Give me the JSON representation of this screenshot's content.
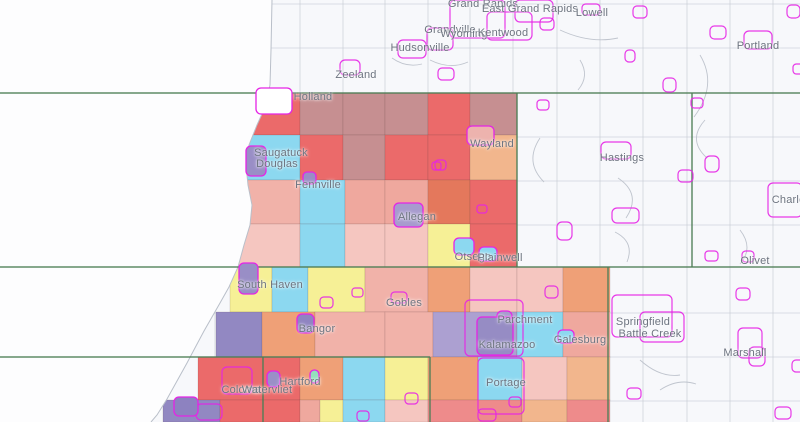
{
  "map": {
    "style": {
      "land_bg": "#f7f8fb",
      "lake_color": "#fdfdfe",
      "coast_color": "#b9bfc9",
      "grid_line_color": "#c6cbd4",
      "road_color": "#b9bfc9",
      "county_line_color": "#4f7f57",
      "city_outline_color": "#e524e5",
      "cell_stroke": "rgba(90,60,60,0.18)",
      "label_color": "#6d7480"
    },
    "legend_note": "choropleth of township/tract cells",
    "cells": [
      {
        "x": 240,
        "y": 93,
        "w": 60,
        "h": 42,
        "c": "#eb6a6a"
      },
      {
        "x": 300,
        "y": 93,
        "w": 43,
        "h": 42,
        "c": "#c68f91"
      },
      {
        "x": 343,
        "y": 93,
        "w": 42,
        "h": 42,
        "c": "#c68f91"
      },
      {
        "x": 385,
        "y": 93,
        "w": 43,
        "h": 42,
        "c": "#c68f91"
      },
      {
        "x": 428,
        "y": 93,
        "w": 42,
        "h": 42,
        "c": "#eb6a6a"
      },
      {
        "x": 470,
        "y": 93,
        "w": 47,
        "h": 42,
        "c": "#c68f91"
      },
      {
        "x": 225,
        "y": 135,
        "w": 75,
        "h": 45,
        "c": "#8cd8f0"
      },
      {
        "x": 300,
        "y": 135,
        "w": 43,
        "h": 45,
        "c": "#eb6a6a"
      },
      {
        "x": 343,
        "y": 135,
        "w": 42,
        "h": 45,
        "c": "#c68f91"
      },
      {
        "x": 385,
        "y": 135,
        "w": 43,
        "h": 45,
        "c": "#eb6a6a"
      },
      {
        "x": 428,
        "y": 135,
        "w": 42,
        "h": 45,
        "c": "#eb6a6a"
      },
      {
        "x": 470,
        "y": 135,
        "w": 47,
        "h": 45,
        "c": "#f2b68d"
      },
      {
        "x": 228,
        "y": 180,
        "w": 72,
        "h": 44,
        "c": "#f1b2a9"
      },
      {
        "x": 300,
        "y": 180,
        "w": 45,
        "h": 44,
        "c": "#8cd8f0"
      },
      {
        "x": 345,
        "y": 180,
        "w": 40,
        "h": 44,
        "c": "#efa89e"
      },
      {
        "x": 385,
        "y": 180,
        "w": 43,
        "h": 44,
        "c": "#efa89e"
      },
      {
        "x": 428,
        "y": 180,
        "w": 42,
        "h": 44,
        "c": "#e4785c"
      },
      {
        "x": 470,
        "y": 180,
        "w": 47,
        "h": 44,
        "c": "#eb6a6a"
      },
      {
        "x": 234,
        "y": 224,
        "w": 66,
        "h": 43,
        "c": "#f5c6c0"
      },
      {
        "x": 300,
        "y": 224,
        "w": 45,
        "h": 43,
        "c": "#8cd8f0"
      },
      {
        "x": 345,
        "y": 224,
        "w": 40,
        "h": 43,
        "c": "#f5c6c0"
      },
      {
        "x": 385,
        "y": 224,
        "w": 43,
        "h": 43,
        "c": "#f5c6c0"
      },
      {
        "x": 428,
        "y": 224,
        "w": 42,
        "h": 43,
        "c": "#f6f096"
      },
      {
        "x": 470,
        "y": 224,
        "w": 47,
        "h": 43,
        "c": "#eb6a6a"
      },
      {
        "x": 230,
        "y": 267,
        "w": 42,
        "h": 45,
        "c": "#f6f096"
      },
      {
        "x": 272,
        "y": 267,
        "w": 36,
        "h": 45,
        "c": "#8cd8f0"
      },
      {
        "x": 308,
        "y": 267,
        "w": 57,
        "h": 45,
        "c": "#f6f096"
      },
      {
        "x": 365,
        "y": 267,
        "w": 63,
        "h": 45,
        "c": "#f1b2a9"
      },
      {
        "x": 428,
        "y": 267,
        "w": 42,
        "h": 45,
        "c": "#efa077"
      },
      {
        "x": 470,
        "y": 267,
        "w": 47,
        "h": 45,
        "c": "#f5c6c0"
      },
      {
        "x": 517,
        "y": 267,
        "w": 46,
        "h": 45,
        "c": "#f5c6c0"
      },
      {
        "x": 563,
        "y": 267,
        "w": 47,
        "h": 45,
        "c": "#efa077"
      },
      {
        "x": 216,
        "y": 312,
        "w": 46,
        "h": 45,
        "c": "#9288c2"
      },
      {
        "x": 262,
        "y": 312,
        "w": 53,
        "h": 45,
        "c": "#efa077"
      },
      {
        "x": 315,
        "y": 312,
        "w": 70,
        "h": 45,
        "c": "#f1b2a9"
      },
      {
        "x": 385,
        "y": 312,
        "w": 48,
        "h": 45,
        "c": "#f1b2a9"
      },
      {
        "x": 433,
        "y": 312,
        "w": 84,
        "h": 45,
        "c": "#aca0d1"
      },
      {
        "x": 517,
        "y": 312,
        "w": 46,
        "h": 45,
        "c": "#8cd8f0"
      },
      {
        "x": 563,
        "y": 312,
        "w": 47,
        "h": 45,
        "c": "#efa89e"
      },
      {
        "x": 198,
        "y": 357,
        "w": 65,
        "h": 43,
        "c": "#eb6a6a"
      },
      {
        "x": 263,
        "y": 357,
        "w": 37,
        "h": 43,
        "c": "#eb6a6a"
      },
      {
        "x": 300,
        "y": 357,
        "w": 43,
        "h": 43,
        "c": "#efa077"
      },
      {
        "x": 343,
        "y": 357,
        "w": 42,
        "h": 43,
        "c": "#8cd8f0"
      },
      {
        "x": 385,
        "y": 357,
        "w": 43,
        "h": 43,
        "c": "#f6f096"
      },
      {
        "x": 428,
        "y": 357,
        "w": 50,
        "h": 43,
        "c": "#efa077"
      },
      {
        "x": 478,
        "y": 357,
        "w": 44,
        "h": 43,
        "c": "#8cd8f0"
      },
      {
        "x": 522,
        "y": 357,
        "w": 45,
        "h": 43,
        "c": "#f5c6c0"
      },
      {
        "x": 567,
        "y": 357,
        "w": 43,
        "h": 43,
        "c": "#f2b68d"
      },
      {
        "x": 163,
        "y": 400,
        "w": 57,
        "h": 22,
        "c": "#9288c2"
      },
      {
        "x": 220,
        "y": 400,
        "w": 43,
        "h": 22,
        "c": "#eb6a6a"
      },
      {
        "x": 263,
        "y": 400,
        "w": 37,
        "h": 22,
        "c": "#eb6a6a"
      },
      {
        "x": 300,
        "y": 400,
        "w": 20,
        "h": 22,
        "c": "#efa89e"
      },
      {
        "x": 320,
        "y": 400,
        "w": 23,
        "h": 22,
        "c": "#f6f096"
      },
      {
        "x": 343,
        "y": 400,
        "w": 42,
        "h": 22,
        "c": "#8cd8f0"
      },
      {
        "x": 385,
        "y": 400,
        "w": 43,
        "h": 22,
        "c": "#f5c6c0"
      },
      {
        "x": 428,
        "y": 400,
        "w": 94,
        "h": 22,
        "c": "#ee8b8b"
      },
      {
        "x": 522,
        "y": 400,
        "w": 45,
        "h": 22,
        "c": "#f2b68d"
      },
      {
        "x": 567,
        "y": 400,
        "w": 43,
        "h": 22,
        "c": "#ee8b8b"
      }
    ],
    "lake": {
      "points": "272,0 271,50 270,85 266,105 257,125 249,145 246,165 248,185 252,205 250,225 244,245 238,267 229,287 220,303 212,317 204,331 196,346 187,363 177,381 167,399 157,415 151,422 0,422 0,0",
      "coast": "272,0 271,50 270,85 266,105 257,125 249,145 246,165 248,185 252,205 250,225 244,245 238,267 229,287 220,303 212,317 204,331 196,346 187,363 177,381 167,399 157,415 151,422"
    },
    "grid": {
      "v": [
        215,
        258,
        300,
        343,
        385,
        428,
        470,
        513,
        557,
        600,
        643,
        687,
        730,
        773
      ],
      "v_y1": 0,
      "v_y2": 422,
      "h": [
        4,
        48,
        137,
        181,
        225,
        313,
        357,
        401
      ],
      "h_x1": 205,
      "h_x2": 800
    },
    "county_lines": [
      {
        "x1": 0,
        "y1": 93,
        "x2": 800,
        "y2": 93
      },
      {
        "x1": 0,
        "y1": 267,
        "x2": 800,
        "y2": 267
      },
      {
        "x1": 0,
        "y1": 357,
        "x2": 430,
        "y2": 357
      },
      {
        "x1": 517,
        "y1": 93,
        "x2": 517,
        "y2": 267
      },
      {
        "x1": 692,
        "y1": 93,
        "x2": 692,
        "y2": 267
      },
      {
        "x1": 608,
        "y1": 267,
        "x2": 608,
        "y2": 422
      },
      {
        "x1": 263,
        "y1": 357,
        "x2": 263,
        "y2": 422
      },
      {
        "x1": 430,
        "y1": 357,
        "x2": 430,
        "y2": 422
      }
    ],
    "roads": [
      "M430,60 q20,10 38,2",
      "M560,30 q30,14 58,8",
      "M700,55 q18,30 -6,62",
      "M618,178 q24,16 8,40",
      "M640,360 q20,18 40,15",
      "M540,138 q-16,24 4,44",
      "M392,58 q14,10 30,6",
      "M705,120 q-18,20 2,38",
      "M615,232 q20,10 12,30",
      "M660,390 q18,-12 36,-6",
      "M740,230 q14,18 0,34",
      "M580,60 q10,16 -2,30"
    ],
    "outlines": [
      {
        "x": 450,
        "y": 0,
        "w": 55,
        "h": 38
      },
      {
        "x": 487,
        "y": 12,
        "w": 45,
        "h": 28
      },
      {
        "x": 515,
        "y": 0,
        "w": 38,
        "h": 22
      },
      {
        "x": 427,
        "y": 28,
        "w": 26,
        "h": 22
      },
      {
        "x": 398,
        "y": 40,
        "w": 28,
        "h": 18
      },
      {
        "x": 340,
        "y": 60,
        "w": 20,
        "h": 15
      },
      {
        "x": 582,
        "y": 4,
        "w": 18,
        "h": 11
      },
      {
        "x": 540,
        "y": 18,
        "w": 14,
        "h": 12
      },
      {
        "x": 633,
        "y": 6,
        "w": 14,
        "h": 12
      },
      {
        "x": 710,
        "y": 26,
        "w": 16,
        "h": 13
      },
      {
        "x": 744,
        "y": 31,
        "w": 28,
        "h": 18
      },
      {
        "x": 787,
        "y": 5,
        "w": 13,
        "h": 13
      },
      {
        "x": 625,
        "y": 50,
        "w": 10,
        "h": 12
      },
      {
        "x": 663,
        "y": 78,
        "w": 13,
        "h": 14
      },
      {
        "x": 793,
        "y": 64,
        "w": 10,
        "h": 10
      },
      {
        "x": 438,
        "y": 68,
        "w": 16,
        "h": 12
      },
      {
        "x": 601,
        "y": 142,
        "w": 30,
        "h": 17
      },
      {
        "x": 705,
        "y": 156,
        "w": 14,
        "h": 16
      },
      {
        "x": 678,
        "y": 170,
        "w": 15,
        "h": 12
      },
      {
        "x": 612,
        "y": 208,
        "w": 27,
        "h": 15
      },
      {
        "x": 557,
        "y": 222,
        "w": 15,
        "h": 18
      },
      {
        "x": 768,
        "y": 183,
        "w": 34,
        "h": 34
      },
      {
        "x": 742,
        "y": 251,
        "w": 12,
        "h": 11
      },
      {
        "x": 705,
        "y": 251,
        "w": 13,
        "h": 10
      },
      {
        "x": 736,
        "y": 288,
        "w": 14,
        "h": 12
      },
      {
        "x": 612,
        "y": 295,
        "w": 60,
        "h": 42
      },
      {
        "x": 640,
        "y": 312,
        "w": 44,
        "h": 30
      },
      {
        "x": 738,
        "y": 328,
        "w": 24,
        "h": 30
      },
      {
        "x": 749,
        "y": 347,
        "w": 16,
        "h": 19
      },
      {
        "x": 792,
        "y": 360,
        "w": 12,
        "h": 12
      },
      {
        "x": 775,
        "y": 407,
        "w": 16,
        "h": 12
      },
      {
        "x": 435,
        "y": 160,
        "w": 11,
        "h": 10
      },
      {
        "x": 320,
        "y": 297,
        "w": 13,
        "h": 11
      },
      {
        "x": 352,
        "y": 288,
        "w": 11,
        "h": 9
      },
      {
        "x": 391,
        "y": 292,
        "w": 16,
        "h": 11
      },
      {
        "x": 405,
        "y": 393,
        "w": 13,
        "h": 11
      },
      {
        "x": 357,
        "y": 411,
        "w": 12,
        "h": 10
      },
      {
        "x": 478,
        "y": 409,
        "w": 18,
        "h": 12
      },
      {
        "x": 509,
        "y": 397,
        "w": 12,
        "h": 10
      },
      {
        "x": 545,
        "y": 286,
        "w": 13,
        "h": 12
      },
      {
        "x": 477,
        "y": 205,
        "w": 10,
        "h": 8
      },
      {
        "x": 432,
        "y": 162,
        "w": 9,
        "h": 8
      },
      {
        "x": 222,
        "y": 367,
        "w": 30,
        "h": 27
      },
      {
        "x": 478,
        "y": 358,
        "w": 46,
        "h": 56
      },
      {
        "x": 465,
        "y": 300,
        "w": 58,
        "h": 56
      },
      {
        "x": 196,
        "y": 404,
        "w": 26,
        "h": 16
      },
      {
        "x": 627,
        "y": 388,
        "w": 14,
        "h": 11
      },
      {
        "x": 691,
        "y": 98,
        "w": 12,
        "h": 10
      },
      {
        "x": 537,
        "y": 100,
        "w": 12,
        "h": 10
      }
    ],
    "markers": [
      {
        "x": 256,
        "y": 88,
        "w": 36,
        "h": 26,
        "fill": "#ffffff"
      },
      {
        "x": 246,
        "y": 146,
        "w": 20,
        "h": 30,
        "fill": "#998ec6"
      },
      {
        "x": 303,
        "y": 172,
        "w": 13,
        "h": 12,
        "fill": "#998ec6"
      },
      {
        "x": 394,
        "y": 203,
        "w": 29,
        "h": 24,
        "fill": "#a79bce"
      },
      {
        "x": 467,
        "y": 126,
        "w": 27,
        "h": 19,
        "fill": "#edb3ae"
      },
      {
        "x": 454,
        "y": 238,
        "w": 20,
        "h": 17,
        "fill": "#8cd8f0"
      },
      {
        "x": 479,
        "y": 247,
        "w": 18,
        "h": 14,
        "fill": "#8cd8f0"
      },
      {
        "x": 239,
        "y": 263,
        "w": 19,
        "h": 31,
        "fill": "#998ec6"
      },
      {
        "x": 297,
        "y": 314,
        "w": 17,
        "h": 19,
        "fill": "#8f84c1"
      },
      {
        "x": 497,
        "y": 311,
        "w": 15,
        "h": 15,
        "fill": "#a79bce"
      },
      {
        "x": 477,
        "y": 317,
        "w": 36,
        "h": 38,
        "fill": "#968cc4"
      },
      {
        "x": 310,
        "y": 370,
        "w": 9,
        "h": 13,
        "fill": "#93e0bd"
      },
      {
        "x": 267,
        "y": 371,
        "w": 13,
        "h": 16,
        "fill": "#9a8fc7"
      },
      {
        "x": 558,
        "y": 330,
        "w": 16,
        "h": 13,
        "fill": "#8cd8f0"
      },
      {
        "x": 174,
        "y": 397,
        "w": 24,
        "h": 19,
        "fill": "#8d82c0"
      }
    ],
    "labels": [
      {
        "text": "Grand Rapids",
        "x": 483,
        "y": 4
      },
      {
        "text": "East Grand Rapids",
        "x": 530,
        "y": 9
      },
      {
        "text": "Grandville",
        "x": 450,
        "y": 30
      },
      {
        "text": "Wyoming",
        "x": 464,
        "y": 34
      },
      {
        "text": "Kentwood",
        "x": 503,
        "y": 33
      },
      {
        "text": "Hudsonville",
        "x": 420,
        "y": 48
      },
      {
        "text": "Lowell",
        "x": 592,
        "y": 13
      },
      {
        "text": "Portland",
        "x": 758,
        "y": 46
      },
      {
        "text": "Zeeland",
        "x": 356,
        "y": 75
      },
      {
        "text": "Holland",
        "x": 313,
        "y": 97
      },
      {
        "text": "Saugatuck",
        "x": 281,
        "y": 153
      },
      {
        "text": "Douglas",
        "x": 277,
        "y": 164
      },
      {
        "text": "Fennville",
        "x": 318,
        "y": 185
      },
      {
        "text": "Wayland",
        "x": 492,
        "y": 144
      },
      {
        "text": "Hastings",
        "x": 622,
        "y": 158
      },
      {
        "text": "Allegan",
        "x": 417,
        "y": 217
      },
      {
        "text": "Otsego",
        "x": 473,
        "y": 257
      },
      {
        "text": "Plainwell",
        "x": 500,
        "y": 258
      },
      {
        "text": "Olivet",
        "x": 755,
        "y": 261
      },
      {
        "text": "Charlotte",
        "x": 795,
        "y": 200
      },
      {
        "text": "South Haven",
        "x": 270,
        "y": 285
      },
      {
        "text": "Gobles",
        "x": 404,
        "y": 303
      },
      {
        "text": "Bangor",
        "x": 317,
        "y": 329
      },
      {
        "text": "Parchment",
        "x": 525,
        "y": 320
      },
      {
        "text": "Kalamazoo",
        "x": 507,
        "y": 345
      },
      {
        "text": "Galesburg",
        "x": 580,
        "y": 340
      },
      {
        "text": "Springfield",
        "x": 643,
        "y": 322
      },
      {
        "text": "Battle Creek",
        "x": 650,
        "y": 334
      },
      {
        "text": "Marshall",
        "x": 745,
        "y": 353
      },
      {
        "text": "Portage",
        "x": 506,
        "y": 383
      },
      {
        "text": "Hartford",
        "x": 300,
        "y": 382
      },
      {
        "text": "Coloma",
        "x": 241,
        "y": 390
      },
      {
        "text": "Watervliet",
        "x": 267,
        "y": 390
      }
    ]
  }
}
